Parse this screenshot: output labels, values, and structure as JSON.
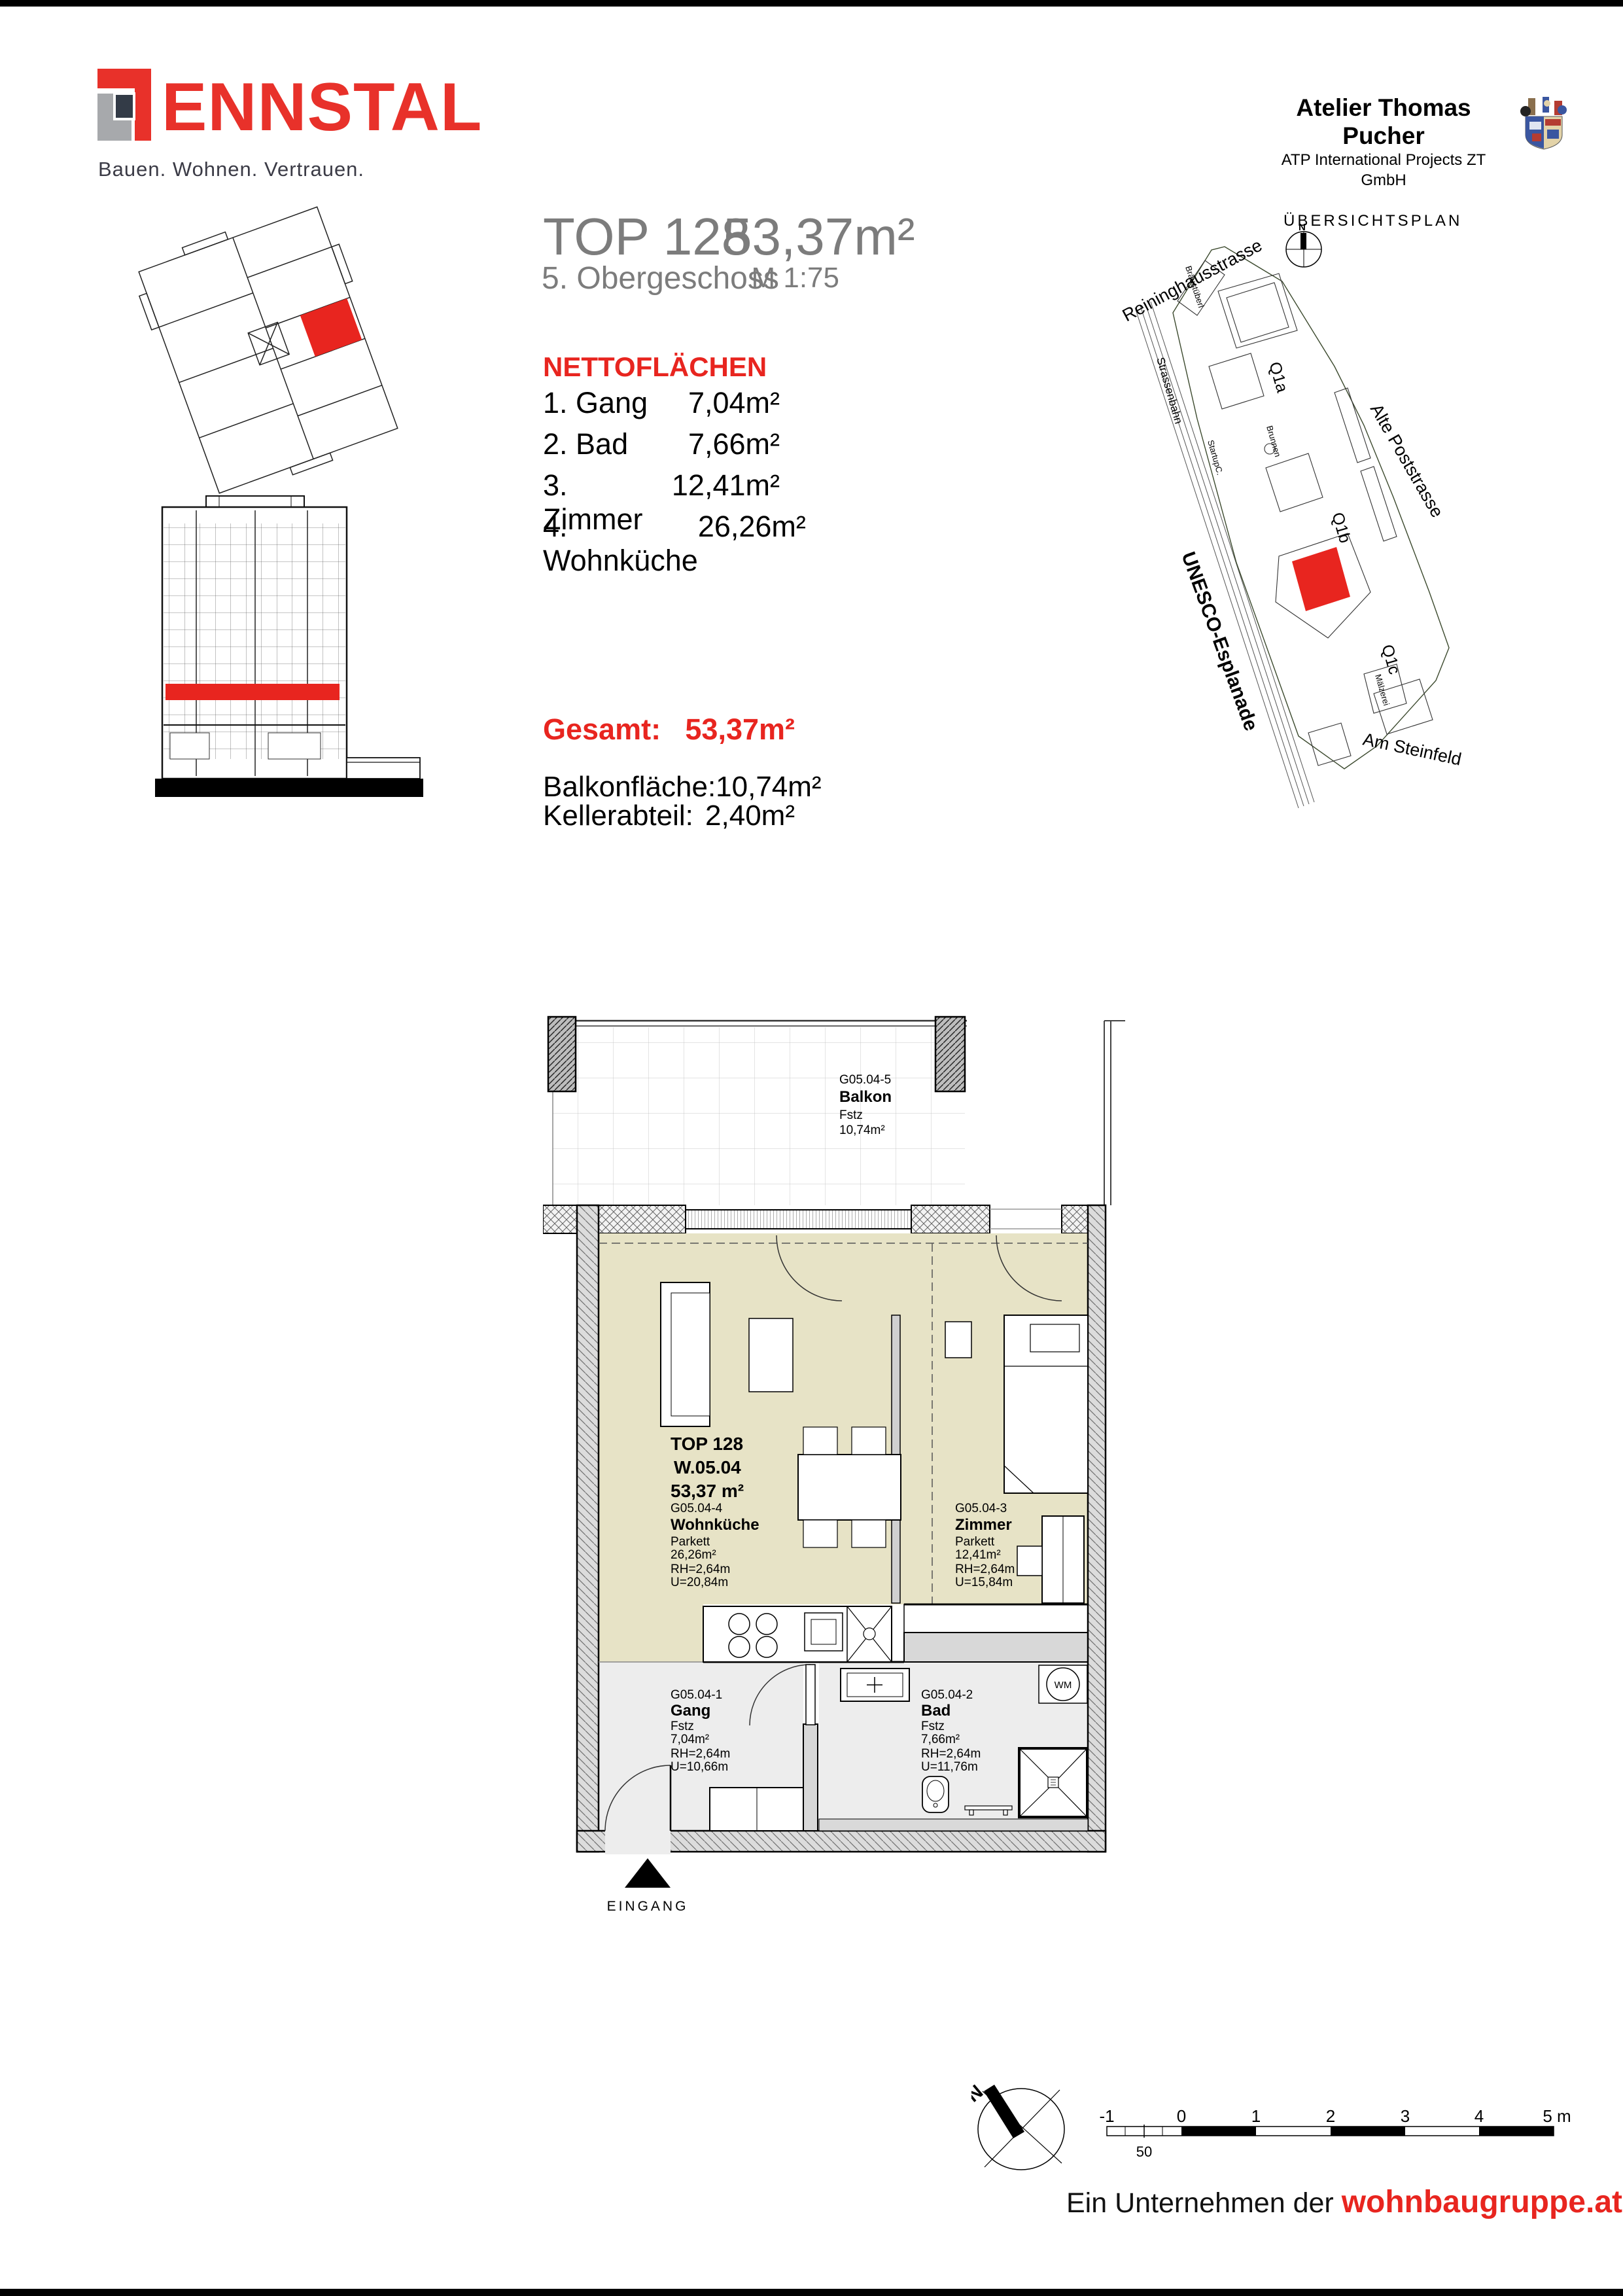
{
  "colors": {
    "accent_red": "#e8251f",
    "logo_red": "#e8312a",
    "logo_navy": "#333b47",
    "logo_gray": "#a7a9ac",
    "title_gray": "#7c7c7c",
    "room_beige": "#e7e3c6",
    "room_gray": "#ededed",
    "wall_gray": "#d8d8d8"
  },
  "header": {
    "logo_text": "ENNSTAL",
    "tagline": "Bauen. Wohnen. Vertrauen.",
    "architect": {
      "name": "Atelier Thomas Pucher",
      "subtitle": "ATP International Projects ZT GmbH"
    }
  },
  "title_block": {
    "unit": "TOP 128",
    "floor": "5. Obergeschoss",
    "area": "53,37m²",
    "scale": "M 1:75"
  },
  "netto": {
    "heading": "NETTOFLÄCHEN",
    "rows": [
      {
        "label": "1. Gang",
        "value": "7,04m²"
      },
      {
        "label": "2. Bad",
        "value": "7,66m²"
      },
      {
        "label": "3. Zimmer",
        "value": "12,41m²"
      },
      {
        "label": "4. Wohnküche",
        "value": "26,26m²"
      }
    ],
    "total": {
      "label": "Gesamt:",
      "value": "53,37m²"
    },
    "extras": [
      {
        "label": "Balkonfläche:",
        "value": "10,74m²"
      },
      {
        "label": "Kellerabteil:",
        "value": "2,40m²"
      }
    ]
  },
  "siteplan": {
    "title": "ÜBERSICHTSPLAN",
    "north": "N",
    "streets": {
      "reininghausstrasse": "Reininghausstrasse",
      "strassenbahn": "Strassenbahn",
      "unesco": "UNESCO-Esplanade",
      "poststrasse": "Alte Poststrasse",
      "steinfeld": "Am Steinfeld"
    },
    "blocks": {
      "q1a": "Q1a",
      "q1b": "Q1b",
      "q1c": "Q1c"
    },
    "pois": {
      "braeustueberl": "Bräustüberl",
      "brunnen": "Brunnen",
      "startup": "StartupC.",
      "maelzerei": "Mälzerei"
    }
  },
  "floorplan": {
    "unit": {
      "line1": "TOP 128",
      "line2": "W.05.04",
      "line3": "53,37 m²"
    },
    "rooms": {
      "balkon": {
        "code": "G05.04-5",
        "name": "Balkon",
        "floor": "Fstz",
        "area": "10,74m²"
      },
      "wohnkueche": {
        "code": "G05.04-4",
        "name": "Wohnküche",
        "floor": "Parkett",
        "area": "26,26m²",
        "rh": "RH=2,64m",
        "u": "U=20,84m"
      },
      "zimmer": {
        "code": "G05.04-3",
        "name": "Zimmer",
        "floor": "Parkett",
        "area": "12,41m²",
        "rh": "RH=2,64m",
        "u": "U=15,84m"
      },
      "gang": {
        "code": "G05.04-1",
        "name": "Gang",
        "floor": "Fstz",
        "area": "7,04m²",
        "rh": "RH=2,64m",
        "u": "U=10,66m"
      },
      "bad": {
        "code": "G05.04-2",
        "name": "Bad",
        "floor": "Fstz",
        "area": "7,66m²",
        "rh": "RH=2,64m",
        "u": "U=11,76m"
      }
    },
    "labels": {
      "eingang": "EINGANG",
      "wm": "WM"
    }
  },
  "scalebar": {
    "ticks": [
      "-1",
      "0",
      "1",
      "2",
      "3",
      "4",
      "5 m"
    ],
    "half": "50"
  },
  "compass_bottom": {
    "north": "N"
  },
  "footer": {
    "prefix": "Ein Unternehmen der ",
    "brand": "wohnbaugruppe.at"
  }
}
